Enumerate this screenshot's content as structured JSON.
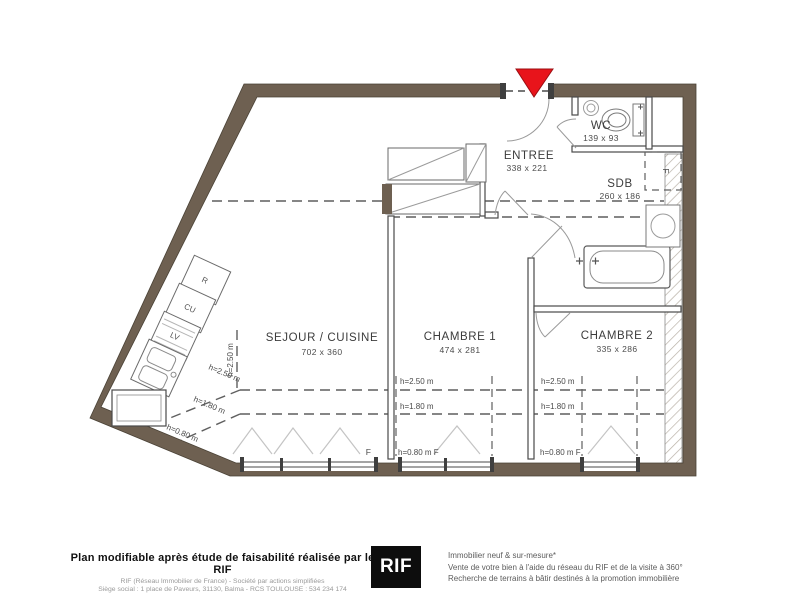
{
  "plan": {
    "rooms": [
      {
        "id": "sejour",
        "name": "SEJOUR / CUISINE",
        "dims": "702 x 360"
      },
      {
        "id": "chambre1",
        "name": "CHAMBRE 1",
        "dims": "474 x 281"
      },
      {
        "id": "chambre2",
        "name": "CHAMBRE 2",
        "dims": "335 x 286"
      },
      {
        "id": "entree",
        "name": "ENTREE",
        "dims": "338 x 221"
      },
      {
        "id": "wc",
        "name": "WC",
        "dims": "139 x 93"
      },
      {
        "id": "sdb",
        "name": "SDB",
        "dims": "260 x 186"
      }
    ],
    "kitchen_units": [
      {
        "label": "R"
      },
      {
        "label": "CU"
      },
      {
        "label": "LV"
      }
    ],
    "heights": {
      "h250": "h=2.50 m",
      "h180": "h=1.80 m",
      "h080": "h=0.80 m",
      "h080f": "h=0.80 m F"
    },
    "window_label": "F",
    "colors": {
      "wall": "#6e6051",
      "entrance_marker": "#e8141b"
    }
  },
  "footer": {
    "left_bold": "Plan modifiable après étude de faisabilité réalisée par le RIF",
    "left_line2": "RIF (Réseau Immobilier de France) - Société par actions simplifiées",
    "left_line3": "Siège social : 1 place de Paveurs, 31130, Balma - RCS TOULOUSE : 534 234 174",
    "logo_text": "RIF",
    "right_line1": "Immobilier neuf & sur-mesure*",
    "right_line2": "Vente de votre bien à l'aide du réseau du RIF et de la visite à 360°",
    "right_line3": "Recherche de terrains à bâtir destinés à la promotion immobilière"
  }
}
